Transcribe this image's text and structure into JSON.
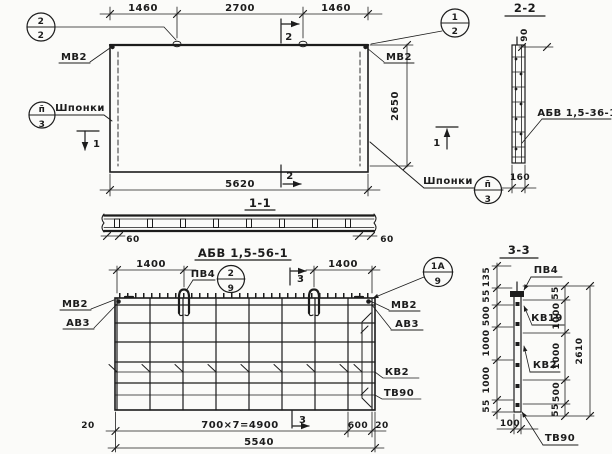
{
  "paper": {
    "bg": "#fbfbf9",
    "ink": "#1c1c1c"
  },
  "plan": {
    "dim_top_left": "1460",
    "dim_top_mid": "2700",
    "dim_top_right": "1460",
    "dim_width": "5620",
    "dim_height": "2650",
    "anchor_left": "МВ2",
    "anchor_right": "МВ2",
    "keys_left": "Шпонки",
    "keys_right": "Шпонки",
    "cut1": "1",
    "cut2": "2",
    "marker_top_left": {
      "num": "2",
      "den": "2"
    },
    "marker_top_right": {
      "num": "1",
      "den": "2"
    },
    "marker_keys_left": {
      "num": "п̄",
      "den": "3"
    },
    "marker_keys_right": {
      "num": "п̄",
      "den": "3"
    }
  },
  "section_1_1": {
    "title": "1-1",
    "dim_left": "60",
    "dim_right": "60",
    "mesh_title": "АБВ 1,5-56-1"
  },
  "section_2_2": {
    "title": "2-2",
    "dim_top": "90",
    "dim_bottom": "160",
    "mesh_label": "АБВ 1,5-36-1"
  },
  "grid_plan": {
    "dim_loop_left": "1400",
    "dim_loop_right": "1400",
    "loop_label": "ПВ4",
    "marker_loop": {
      "num": "2",
      "den": "9"
    },
    "marker_corner": {
      "num": "1А",
      "den": "9"
    },
    "anchor_left_1": "МВ2",
    "anchor_left_2": "АВ3",
    "anchor_right_1": "МВ2",
    "anchor_right_2": "АВ3",
    "bar_label_1": "КВ2",
    "bar_label_2": "ТВ90",
    "cut3": "3",
    "dim_20_left": "20",
    "dim_spacing": "700×7=4900",
    "dim_600": "600",
    "dim_20_right": "20",
    "dim_total": "5540"
  },
  "section_3_3": {
    "title": "3-3",
    "left_dims": [
      "135",
      "55",
      "500",
      "1000",
      "1000",
      "55"
    ],
    "dim_width": "100",
    "right_dims": [
      "55",
      "1000",
      "1000",
      "500",
      "55"
    ],
    "dim_height": "2610",
    "label_top": "ПВ4",
    "label_kv19": "КВ19",
    "label_kv2": "КВ2",
    "label_tv90": "ТВ90"
  }
}
